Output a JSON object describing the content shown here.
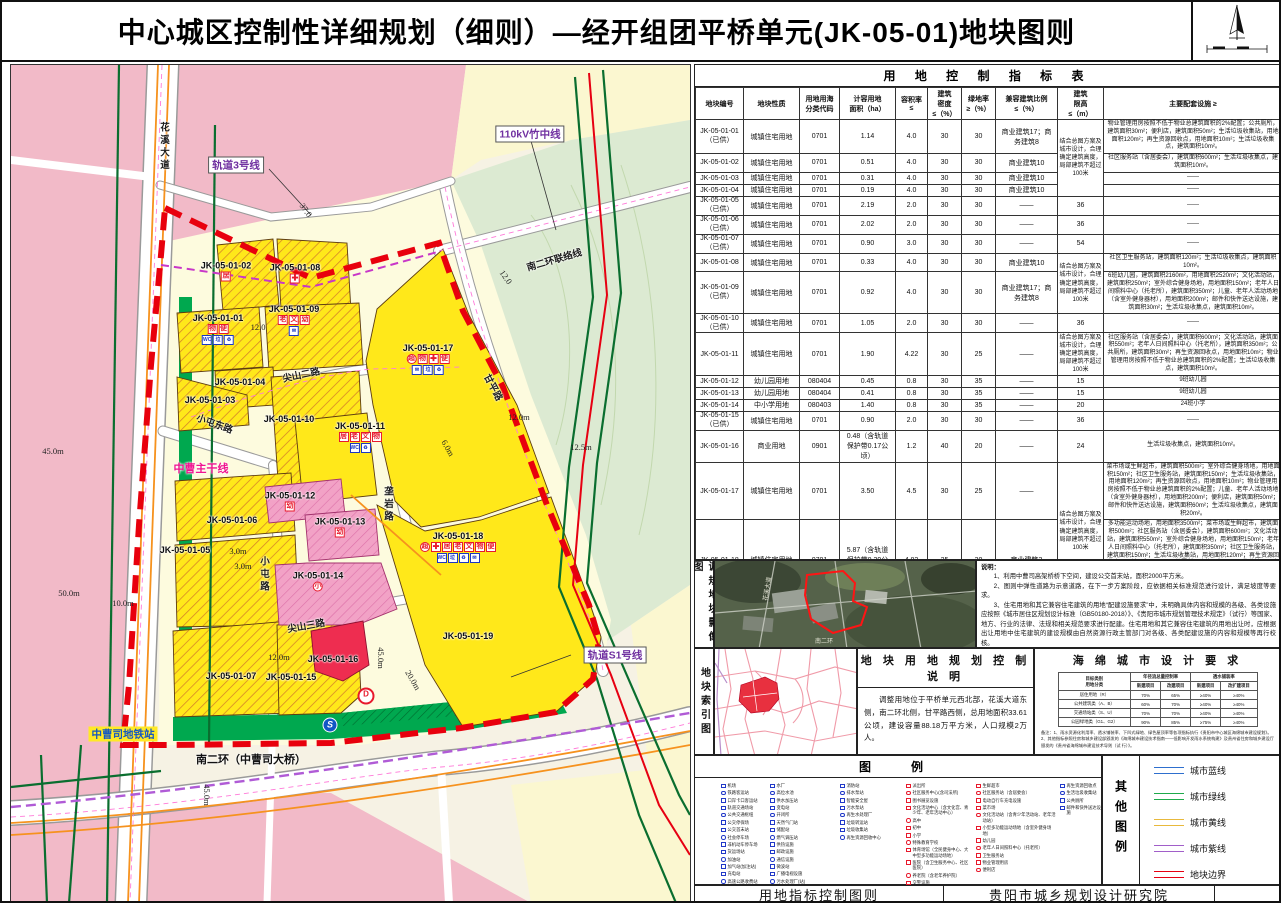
{
  "title": "中心城区控制性详细规划（细则）—经开组团平桥单元(JK-05-01)地块图则",
  "table": {
    "title": "用 地 控 制 指 标 表",
    "headers": [
      "地块编号",
      "地块性质",
      "用地用海\n分类代码",
      "计容用地\n面积（ha）",
      "容积率\n≤",
      "建筑\n密度\n≤（%）",
      "绿地率\n≥（%）",
      "兼容建筑比例\n≤（%）",
      "建筑\n限高\n≤（m）",
      "主要配套设施 ≥"
    ],
    "merged_height_note": "结合总图方案及城市设计，合理确定建筑高度，局部建筑不超过100米",
    "rows": [
      {
        "cells": [
          "JK-05-01-01\n（已供）",
          "城镇住宅用地",
          "0701",
          "1.14",
          "4.0",
          "30",
          "30",
          "商业建筑17；商\n务建筑8",
          {
            "t": "结合总图方案及城市设计，合理确定建筑高度，局部建筑不超过100米",
            "rs": 4
          },
          "物业管理用房按照不低于物业总建筑面积的2%配置；公共厕所，建筑面积30m²；便利店，建筑面积50m²；生活垃圾收集站，用地面积120m²；再生资源回收点，用地面积10m²；生活垃圾收集点，建筑面积10m²。"
        ]
      },
      {
        "cells": [
          "JK-05-01-02",
          "城镇住宅用地",
          "0701",
          "0.51",
          "4.0",
          "30",
          "30",
          "商业建筑10",
          null,
          "社区服务站（含居委会），建筑面积600m²；生活垃圾收集点，建筑面积10m²。"
        ]
      },
      {
        "cells": [
          "JK-05-01-03",
          "城镇住宅用地",
          "0701",
          "0.31",
          "4.0",
          "30",
          "30",
          "商业建筑10",
          null,
          "——"
        ]
      },
      {
        "cells": [
          "JK-05-01-04",
          "城镇住宅用地",
          "0701",
          "0.19",
          "4.0",
          "30",
          "30",
          "商业建筑10",
          null,
          "——"
        ]
      },
      {
        "cells": [
          "JK-05-01-05\n（已供）",
          "城镇住宅用地",
          "0701",
          "2.19",
          "2.0",
          "30",
          "30",
          "——",
          "36",
          "——"
        ]
      },
      {
        "cells": [
          "JK-05-01-06\n（已供）",
          "城镇住宅用地",
          "0701",
          "2.02",
          "2.0",
          "30",
          "30",
          "——",
          "36",
          "——"
        ]
      },
      {
        "cells": [
          "JK-05-01-07\n（已供）",
          "城镇住宅用地",
          "0701",
          "0.90",
          "3.0",
          "30",
          "30",
          "——",
          "54",
          "——"
        ]
      },
      {
        "cells": [
          "JK-05-01-08",
          "城镇住宅用地",
          "0701",
          "0.33",
          "4.0",
          "30",
          "30",
          "商业建筑10",
          {
            "t": "结合总图方案及城市设计，合理确定建筑高度，局部建筑不超过100米",
            "rs": 2
          },
          "社区卫生服务站，建筑面积120m²；生活垃圾收集点，建筑面积10m²。"
        ]
      },
      {
        "cells": [
          "JK-05-01-09\n（已供）",
          "城镇住宅用地",
          "0701",
          "0.92",
          "4.0",
          "30",
          "30",
          "商业建筑17；商\n务建筑8",
          null,
          "6班幼儿园，建筑面积2160m²，用地面积2520m²；文化活动站，建筑面积250m²；室外综合健身场地，用地面积150m²；老年人日间照料中心（托老所），建筑面积350m²；儿童、老年人活动场地（含室外健身器材），用地面积200m²；邮件和快件送达设施，建筑面积30m²；生活垃圾收集点，建筑面积10m²。"
        ]
      },
      {
        "cells": [
          "JK-05-01-10\n（已供）",
          "城镇住宅用地",
          "0701",
          "1.05",
          "2.0",
          "30",
          "30",
          "——",
          "36",
          "——"
        ]
      },
      {
        "cells": [
          "JK-05-01-11",
          "城镇住宅用地",
          "0701",
          "1.90",
          "4.22",
          "30",
          "25",
          "——",
          "结合总图方案及城市设计，合理确定建筑高度，局部建筑不超过100米",
          "社区服务站（含居委会），建筑面积600m²；文化活动站，建筑面积550m²；老年人日间照料中心（托老所），建筑面积350m²；公共厕所，建筑面积30m²；再生资源回收点，用地面积10m²；物业管理用房按照不低于物业总建筑面积的2%配置；生活垃圾收集点，建筑面积10m²。"
        ]
      },
      {
        "cells": [
          "JK-05-01-12",
          "幼儿园用地",
          "080404",
          "0.45",
          "0.8",
          "30",
          "35",
          "——",
          "15",
          "9班幼儿园"
        ]
      },
      {
        "cells": [
          "JK-05-01-13",
          "幼儿园用地",
          "080404",
          "0.41",
          "0.8",
          "30",
          "35",
          "——",
          "15",
          "9班幼儿园"
        ]
      },
      {
        "cells": [
          "JK-05-01-14",
          "中小学用地",
          "080403",
          "1.40",
          "0.8",
          "30",
          "35",
          "——",
          "20",
          "24班小学"
        ]
      },
      {
        "cells": [
          "JK-05-01-15\n（已供）",
          "城镇住宅用地",
          "0701",
          "0.90",
          "2.0",
          "30",
          "30",
          "——",
          "36",
          "——"
        ]
      },
      {
        "cells": [
          "JK-05-01-16",
          "商业用地",
          "0901",
          "0.48（含轨道\n保护带0.17公\n顷）",
          "1.2",
          "40",
          "20",
          "——",
          "24",
          "生活垃圾收集点，建筑面积10m²。"
        ]
      },
      {
        "cells": [
          "JK-05-01-17",
          "城镇住宅用地",
          "0701",
          "3.50",
          "4.5",
          "30",
          "25",
          "——",
          {
            "t": "结合总图方案及城市设计，合理确定建筑高度，局部建筑不超过100米",
            "rs": 2
          },
          "菜市场或生鲜超市，建筑面积500m²；室外综合健身场地，用地面积150m²；社区卫生服务站，建筑面积150m²；生活垃圾收集站，用地面积120m²；再生资源回收点，用地面积10m²；物业管理用房按照不低于物业总建筑面积的2%配置；儿童、老年人活动场地（含室外健身器材），用地面积200m²；便利店，建筑面积50m²；邮件和快件送达设施，建筑面积60m²；生活垃圾收集点，建筑面积20m²。"
        ]
      },
      {
        "cells": [
          "JK-05-01-18",
          "城镇住宅用地",
          "0701",
          "5.87（含轨道\n保护带0.39公\n顷）",
          "4.82",
          "25",
          "30",
          "商业建筑3",
          null,
          "多功能运动场地，用地面积3500m²；菜市场或生鲜超市，建筑面积500m²；社区服务站（含居委会），建筑面积600m²；文化活动站，建筑面积550m²；室外综合健身场地，用地面积150m²；老年人日间照料中心（托老所），建筑面积350m²；社区卫生服务站，建筑面积150m²；生活垃圾收集站，用地面积120m²；再生资源回收点，用地面积10m²；公共厕所，建筑面积30m²；物业管理用房按照不低于物业总建筑面积的2%配置；儿童、老年人活动场地（含室外健身器材），用地面积200m²；便利店，建筑面积50m²；邮件和快件送达设施，建筑面积60m²；生活垃圾收集点，建筑面积20m²。"
        ]
      },
      {
        "cells": [
          "JK-05-01-19\n（已供）",
          "城镇住宅用地",
          "0701",
          "0.32",
          "2.0",
          "30",
          "30",
          "——",
          "36",
          "——"
        ]
      }
    ]
  },
  "panels": {
    "imagery_label": "调规地块影像图",
    "index_label": "地块索引图"
  },
  "notes": {
    "title": "说明：",
    "items": [
      "1、利用中曹司高架桥桥下空间，建设公交首末站，面积2000平方米。",
      "2、图则中弹性道路为示意道路，在下一步方案阶段，应依据相关标准规范进行设计，满足坡度等要求。",
      "3、住宅用地和其它兼容住宅建筑的用地“配建设施要求”中，未明确具体内容和规模的各级、各类设施应按照《城市居住区规划设计标准（GB50180-2018）》、《贵阳市城市规划管理技术规定》（试行）等国家、地方、行业的法律、法规和相关规范要求进行配建。住宅用地和其它兼容住宅建筑的用地出让时，应根据出让用地中住宅建筑的建设规模由自然资源行政主管部门对各级、各类配建设施的内容和规模等再行校核。",
      "4、上述污水处理厂、污水提升泵站、垃圾转运站、变电站、天然气门站、燃气高中压调压站、输油、输气管道、加油加气站、甲醇加注站等会对环境和安全产生影响的公用设施建设，其卫生及安全防护距离应按照国家和各行业相关规范、标准及项目环境影响评价的要求执行。"
    ]
  },
  "control": {
    "title": "地 块 用 地 规 划 控 制 说 明",
    "text": "调整用地位于平桥单元西北部，花溪大道东侧，南二环北侧，甘平路西侧，总用地面积33.61公顷，建设容量88.18万平方米，人口规模2万人。"
  },
  "sponge": {
    "title": "海 绵 城 市 设 计 要 求",
    "header_col": "目标类别\n用地分类",
    "groups": [
      {
        "t": "年径流总量控制率",
        "subs": [
          "新建项目",
          "改建项目"
        ]
      },
      {
        "t": "透水铺装率",
        "subs": [
          "新建项目",
          "改扩建项目"
        ]
      }
    ],
    "rows": [
      [
        "居住用地（R）",
        "70%",
        "65%",
        "≥40%",
        "≥40%"
      ],
      [
        "公共建筑类（A、B）",
        "60%",
        "70%",
        "≥40%",
        "≥40%"
      ],
      [
        "交通场站类（S、U）",
        "70%",
        "70%",
        "≥40%",
        "≥40%"
      ],
      [
        "公园绿地类（G1、G2）",
        "90%",
        "85%",
        "≥75%",
        "≥40%"
      ]
    ],
    "note": "备注：1、雨水资源化利用率、透水铺装率、下凹式绿地、绿色屋顶率等各项指标执行《贵阳市中心城区海绵城市建设规划》。\n2、其他指标参照住房和城乡建设部颁发的《海绵城市建设技术指南——低影响开发雨水系统构建》及贵州省住房和城乡建设厅颁发的《贵州省海绵城市建设技术导则（试 行）》。"
  },
  "legend": {
    "title": "图　例",
    "other_title": "其他图例",
    "columns": [
      {
        "x": 26,
        "w": 46,
        "color": "#2038c8",
        "items": [
          "机场",
          "铁路客运站",
          "口岸卡口客运站",
          "轨道交通场站",
          "公共交通枢纽",
          "公交停保场",
          "公交首末站",
          "社会停车场",
          "非机动车停车场",
          "货运场站",
          "加油站",
          "加气站(加注站)",
          "充电站",
          "高速公路收费站"
        ]
      },
      {
        "x": 75,
        "w": 62,
        "color": "#2038c8",
        "items": [
          "水厂",
          "高位水池",
          "供水加压站",
          "变电站",
          "开闭所",
          "天然气门站",
          "储配站",
          "燃气调压站",
          "供热设施",
          "邮政设施",
          "通信设施",
          "微波站",
          "广播电视设施",
          "污水处理厂(站)"
        ]
      },
      {
        "x": 145,
        "w": 62,
        "color": "#2038c8",
        "items": [
          "消防站",
          "排水泵站",
          "智能安全屋",
          "污水泵站",
          "再生水处理厂",
          "垃圾转运站",
          "垃圾收集站",
          "再生资源回收中心"
        ]
      },
      {
        "x": 211,
        "w": 66,
        "color": "#e8192c",
        "items": [
          "派出所",
          "社区服务中心(含司法所)",
          "图书展览设施",
          "文化活动中心（含文化宫、青少年、老年活动中心）",
          "高中",
          "初中",
          "小学",
          "特殊教育学校",
          "体育场馆（全民健身中心、大中型多功能运动场地）",
          "医院（含卫生服务中心、社区医院）",
          "养老院（含老年养护院）",
          "交警设施",
          "消防设施"
        ]
      },
      {
        "x": 281,
        "w": 80,
        "color": "#e8192c",
        "items": [
          "生鲜超市",
          "社区服务站（含居委会）",
          "电动自行车充电设施",
          "菜市场",
          "文化活动站（含青少年活动站、老年活动站）",
          "小型多功能运动场地（含室外健身场地）",
          "幼儿园",
          "老年人日间照料中心（托老所）",
          "卫生服务站",
          "物业管理用房",
          "便利店"
        ]
      },
      {
        "x": 365,
        "w": 42,
        "color": "#2038c8",
        "items": [
          "再生资源回收点",
          "生活垃圾收集站",
          "公共厕所",
          "邮件和快件送达设施"
        ]
      }
    ],
    "other": [
      {
        "label": "城市蓝线",
        "color": "#2e6fce"
      },
      {
        "label": "城市绿线",
        "color": "#1faa4b"
      },
      {
        "label": "城市黄线",
        "color": "#e8b93c"
      },
      {
        "label": "城市紫线",
        "color": "#a15fc9"
      },
      {
        "label": "地块边界",
        "color": "#e60012"
      }
    ]
  },
  "footer": {
    "left": "用地指标控制图则",
    "right": "贵阳市城乡规划设计研究院"
  },
  "map": {
    "blocks": [
      {
        "id": "JK-05-01-02",
        "x": 215,
        "y": 206,
        "chips": [
          [
            "r",
            "居"
          ]
        ]
      },
      {
        "id": "JK-05-01-08",
        "x": 284,
        "y": 208,
        "chips": [
          [
            "cross",
            "✚"
          ]
        ]
      },
      {
        "id": "JK-05-01-01",
        "x": 207,
        "y": 264,
        "chips": [
          [
            "r",
            "物"
          ],
          [
            "r",
            "便"
          ]
        ],
        "chips2": [
          [
            "b",
            "WC"
          ],
          [
            "b",
            "垃"
          ],
          [
            "b",
            "♻"
          ]
        ]
      },
      {
        "id": "JK-05-01-09",
        "x": 283,
        "y": 255,
        "chips": [
          [
            "r",
            "老"
          ],
          [
            "r",
            "文"
          ],
          [
            "r",
            "幼"
          ]
        ],
        "chips2": [
          [
            "b",
            "✉"
          ]
        ]
      },
      {
        "id": "JK-05-01-04",
        "x": 229,
        "y": 317
      },
      {
        "id": "JK-05-01-03",
        "x": 199,
        "y": 335
      },
      {
        "id": "JK-05-01-10",
        "x": 278,
        "y": 354
      },
      {
        "id": "JK-05-01-17",
        "x": 417,
        "y": 294,
        "chips": [
          [
            "rc",
            "超"
          ],
          [
            "r",
            "物"
          ],
          [
            "cross",
            "✚"
          ],
          [
            "r",
            "便"
          ]
        ],
        "chips2": [
          [
            "b",
            "✉"
          ],
          [
            "b",
            "垃"
          ],
          [
            "b",
            "♻"
          ]
        ]
      },
      {
        "id": "JK-05-01-11",
        "x": 349,
        "y": 372,
        "chips": [
          [
            "r",
            "居"
          ],
          [
            "r",
            "老"
          ],
          [
            "r",
            "文"
          ],
          [
            "r",
            "物"
          ]
        ],
        "chips2": [
          [
            "b",
            "WC"
          ],
          [
            "b",
            "♻"
          ]
        ]
      },
      {
        "id": "JK-05-01-12",
        "x": 279,
        "y": 436,
        "chips": [
          [
            "r",
            "幼"
          ]
        ]
      },
      {
        "id": "JK-05-01-06",
        "x": 221,
        "y": 455
      },
      {
        "id": "JK-05-01-13",
        "x": 329,
        "y": 462,
        "chips": [
          [
            "r",
            "幼"
          ]
        ]
      },
      {
        "id": "JK-05-01-05",
        "x": 174,
        "y": 485
      },
      {
        "id": "JK-05-01-14",
        "x": 307,
        "y": 516,
        "chips": [
          [
            "rc",
            "小"
          ]
        ]
      },
      {
        "id": "JK-05-01-18",
        "x": 447,
        "y": 482,
        "chips": [
          [
            "rc",
            "超"
          ],
          [
            "cross",
            "✚"
          ],
          [
            "r",
            "居"
          ],
          [
            "r",
            "老"
          ],
          [
            "r",
            "文"
          ],
          [
            "r",
            "物"
          ],
          [
            "r",
            "便"
          ]
        ],
        "chips2": [
          [
            "b",
            "WC"
          ],
          [
            "b",
            "垃"
          ],
          [
            "b",
            "♻"
          ],
          [
            "b",
            "✉"
          ]
        ]
      },
      {
        "id": "JK-05-01-16",
        "x": 322,
        "y": 594
      },
      {
        "id": "JK-05-01-07",
        "x": 220,
        "y": 611
      },
      {
        "id": "JK-05-01-15",
        "x": 280,
        "y": 612
      },
      {
        "id": "JK-05-01-19",
        "x": 457,
        "y": 571
      }
    ],
    "roads": [
      {
        "t": "花溪大道",
        "x": 152,
        "y": 82,
        "cls": "road vert"
      },
      {
        "t": "南二环联络线",
        "x": 543,
        "y": 194,
        "cls": "road",
        "rot": -16
      },
      {
        "t": "尖山二路",
        "x": 290,
        "y": 309,
        "cls": "road",
        "rot": -12
      },
      {
        "t": "小屯东路",
        "x": 204,
        "y": 358,
        "cls": "road",
        "rot": 20
      },
      {
        "t": "小屯路",
        "x": 252,
        "y": 510,
        "cls": "road vert"
      },
      {
        "t": "垄岩路",
        "x": 376,
        "y": 440,
        "cls": "road vert"
      },
      {
        "t": "甘平路",
        "x": 483,
        "y": 322,
        "cls": "road",
        "rot": 62
      },
      {
        "t": "尖山三路",
        "x": 295,
        "y": 560,
        "cls": "road",
        "rot": -10
      },
      {
        "t": "南二环（中曹司大桥）",
        "x": 240,
        "y": 694,
        "cls": "road-big"
      },
      {
        "t": "中曹主干线",
        "x": 190,
        "y": 403,
        "cls": "trunk"
      }
    ],
    "callouts": [
      {
        "t": "轨道3号线",
        "x": 225,
        "y": 100,
        "color": "#7030a0"
      },
      {
        "t": "110kV竹中线",
        "x": 519,
        "y": 69,
        "color": "#7030a0"
      },
      {
        "t": "轨道S1号线",
        "x": 604,
        "y": 590,
        "color": "#7030a0"
      },
      {
        "t": "中曹司地铁站",
        "x": 112,
        "y": 669,
        "color": "#1256c4",
        "bg": "#ffe926",
        "noborder": true
      }
    ],
    "dims": [
      {
        "t": "37.0",
        "x": 295,
        "y": 145,
        "rot": 55
      },
      {
        "t": "12.0",
        "x": 247,
        "y": 262
      },
      {
        "t": "12.0",
        "x": 495,
        "y": 212,
        "rot": 55
      },
      {
        "t": "12.0m",
        "x": 508,
        "y": 352
      },
      {
        "t": "12.5m",
        "x": 570,
        "y": 382
      },
      {
        "t": "6.0m",
        "x": 437,
        "y": 383,
        "rot": 60
      },
      {
        "t": "45.0m",
        "x": 42,
        "y": 386
      },
      {
        "t": "50.0m",
        "x": 58,
        "y": 528
      },
      {
        "t": "10.0m",
        "x": 112,
        "y": 538
      },
      {
        "t": "3.0m",
        "x": 227,
        "y": 486
      },
      {
        "t": "3.0m",
        "x": 232,
        "y": 501
      },
      {
        "t": "12.0m",
        "x": 268,
        "y": 592
      },
      {
        "t": "45.0m",
        "x": 370,
        "y": 593,
        "vert": true
      },
      {
        "t": "20.0m",
        "x": 402,
        "y": 615,
        "rot": 60
      },
      {
        "t": "45.0m",
        "x": 196,
        "y": 730,
        "vert": true
      }
    ],
    "symbols": [
      {
        "t": "D",
        "x": 355,
        "y": 631,
        "cls": "sym-d"
      },
      {
        "t": "S",
        "x": 319,
        "y": 660,
        "cls": "sym-metro"
      }
    ]
  }
}
